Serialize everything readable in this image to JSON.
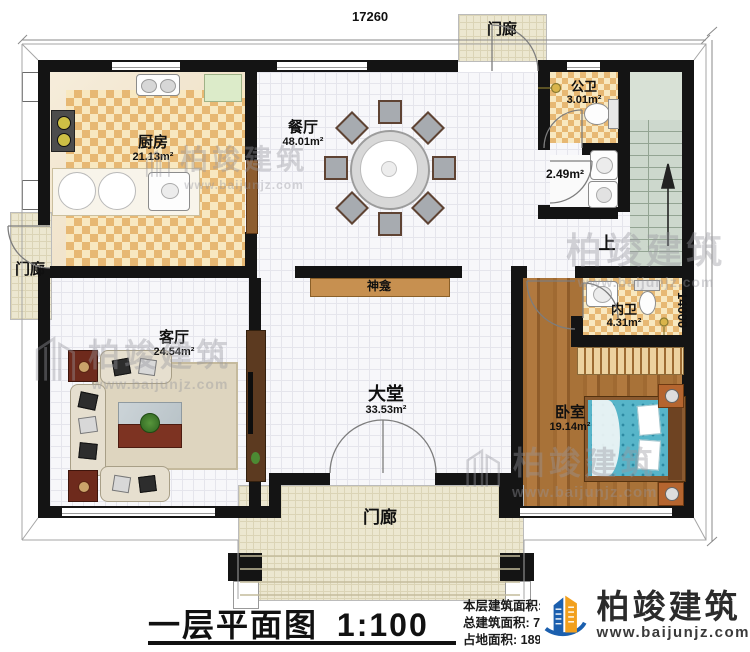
{
  "dimensions": {
    "top": "17260",
    "right": "14000"
  },
  "rooms": {
    "kitchen": {
      "name": "厨房",
      "area": "21.13m²"
    },
    "dining": {
      "name": "餐厅",
      "area": "48.01m²"
    },
    "public_bath": {
      "name": "公卫",
      "area": "3.01m²"
    },
    "laundry": {
      "area": "2.49m²"
    },
    "living": {
      "name": "客厅",
      "area": "24.54m²"
    },
    "hall": {
      "name": "大堂",
      "area": "33.53m²"
    },
    "bedroom": {
      "name": "卧室",
      "area": "19.14m²"
    },
    "ensuite": {
      "name": "内卫",
      "area": "4.31m²"
    }
  },
  "labels": {
    "porch": "门廊",
    "shrine": "神龛",
    "up": "上"
  },
  "title": {
    "text": "一层平面图",
    "scale": "1:100"
  },
  "stats": {
    "floor_area_label": "本层建筑面积:",
    "floor_area": "189.81m²",
    "storey_height_label": "层高:",
    "storey_height": "4.2m",
    "total_area_label": "总建筑面积:",
    "total_area": "716.03m²",
    "footprint_label": "占地面积:",
    "footprint": "189.81m²"
  },
  "brand": {
    "name": "柏竣建筑",
    "website": "www.baijunjz.com"
  },
  "watermark": {
    "name": "柏竣建筑",
    "website": "www.baijunjz.com"
  },
  "colors": {
    "wall": "#141414",
    "checker": "#e7b873",
    "brand_blue": "#1b5fae",
    "brand_orange": "#f2a01d",
    "bed": "#57b5c9"
  }
}
